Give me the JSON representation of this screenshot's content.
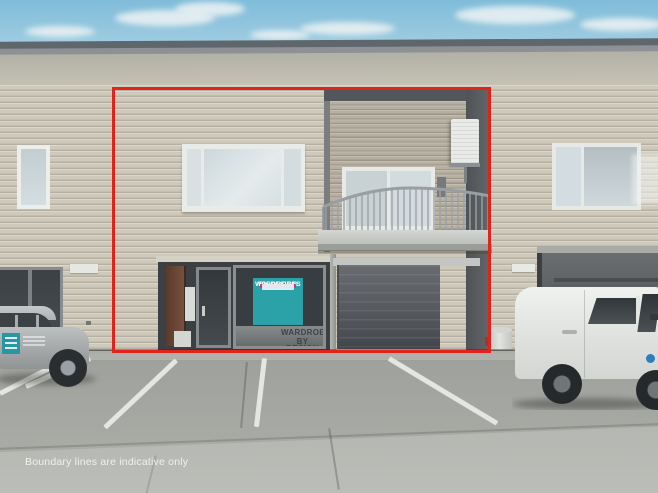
{
  "meta": {
    "description": "Real-estate exterior photo of a two-storey commercial unit outlined in red",
    "width_px": 658,
    "height_px": 493
  },
  "overlay": {
    "disclaimer": "Boundary lines are indicative only",
    "boundary_color": "#e2231b"
  },
  "signage": {
    "window_sign": {
      "line1": "WARDROBES",
      "line2": "BY DESIGN",
      "bg_color": "#2aa2a8",
      "accent_color": "#c23a80"
    },
    "glass_decal": {
      "line1": "WARDROBES",
      "line2": "BY DESIGN"
    }
  },
  "palette": {
    "sky": "#8fc3dc",
    "cloud": "#eef3f4",
    "roof_fascia": "#5f666c",
    "siding": "#cfc9bc",
    "balcony_recess": "#b6afa1",
    "garage_door": "#55585c",
    "dark_pillar": "#5b5e61",
    "asphalt": "#a3a5a0",
    "concrete": "#b4b6b1",
    "parking_line": "#e4e6e1",
    "car": "#b0b4b5",
    "van": "#e7e9e6"
  }
}
